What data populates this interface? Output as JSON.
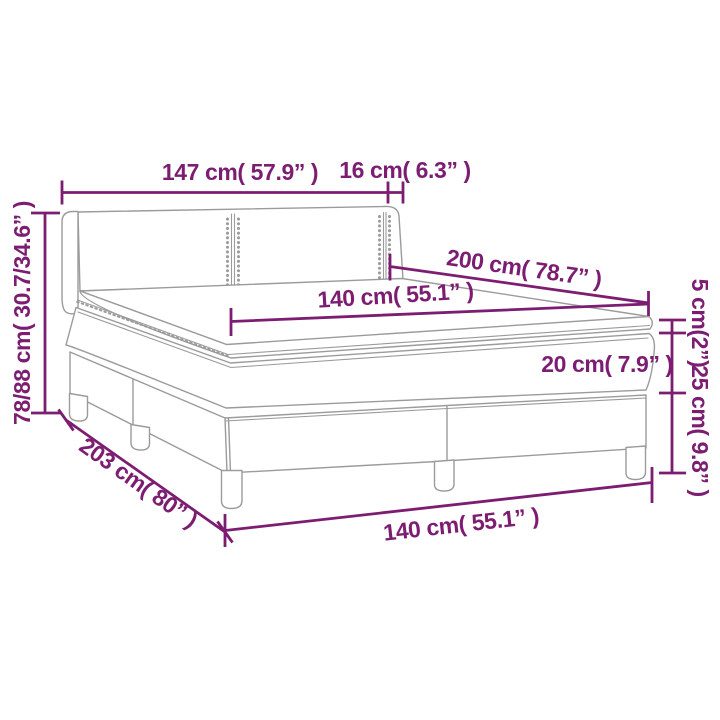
{
  "diagram": {
    "type": "product-dimension-diagram",
    "subject": "box-spring-bed-with-headboard",
    "colors": {
      "dimension": "#7c1d72",
      "outline": "#9b9b9b",
      "background": "#ffffff"
    },
    "dimensions": {
      "headboard_width": "147 cm( 57.9” )",
      "wing_depth": "16 cm( 6.3” )",
      "total_height": "78/88 cm( 30.7/34.6” )",
      "bed_length": "200 cm( 78.7” )",
      "mattress_width_top": "140 cm( 55.1” )",
      "topper_height": "5 cm(2”)",
      "mattress_height": "20 cm( 7.9” )",
      "base_height": "25 cm( 9.8” )",
      "total_length": "203 cm( 80” )",
      "bed_width_bottom": "140 cm( 55.1” )"
    }
  }
}
